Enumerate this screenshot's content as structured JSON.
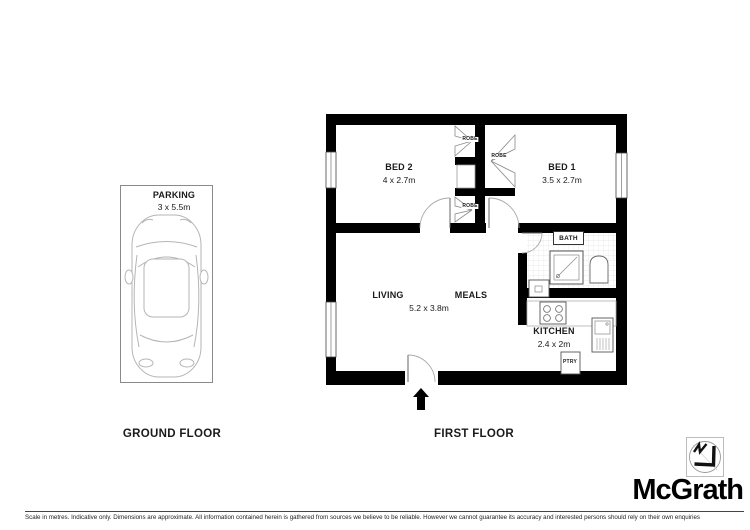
{
  "ground_floor": {
    "title": "GROUND FLOOR",
    "parking_label": "PARKING",
    "parking_dims": "3 x 5.5m"
  },
  "first_floor": {
    "title": "FIRST FLOOR",
    "bed2_label": "BED 2",
    "bed2_dims": "4 x 2.7m",
    "bed1_label": "BED 1",
    "bed1_dims": "3.5 x 2.7m",
    "robe_top_label": "ROBE",
    "robe_right_label": "ROBE",
    "robe_bottom_label": "ROBE",
    "living_label": "LIVING",
    "meals_label": "MEALS",
    "living_meals_dims": "5.2 x 3.8m",
    "bath_label": "BATH",
    "kitchen_label": "KITCHEN",
    "kitchen_dims": "2.4 x 2m",
    "pantry_label": "PTRY"
  },
  "branding": {
    "wordmark": "McGrath",
    "compass_icon": "north-compass-icon"
  },
  "footer": {
    "disclaimer": "Scale in metres. Indicative only. Dimensions are approximate. All information contained herein is gathered from sources we believe to be reliable. However we cannot guarantee its accuracy and interested persons should rely on their own enquiries"
  },
  "colors": {
    "wall": "#000000",
    "thin_line": "#9b9b9b",
    "text": "#1a1a1a"
  }
}
